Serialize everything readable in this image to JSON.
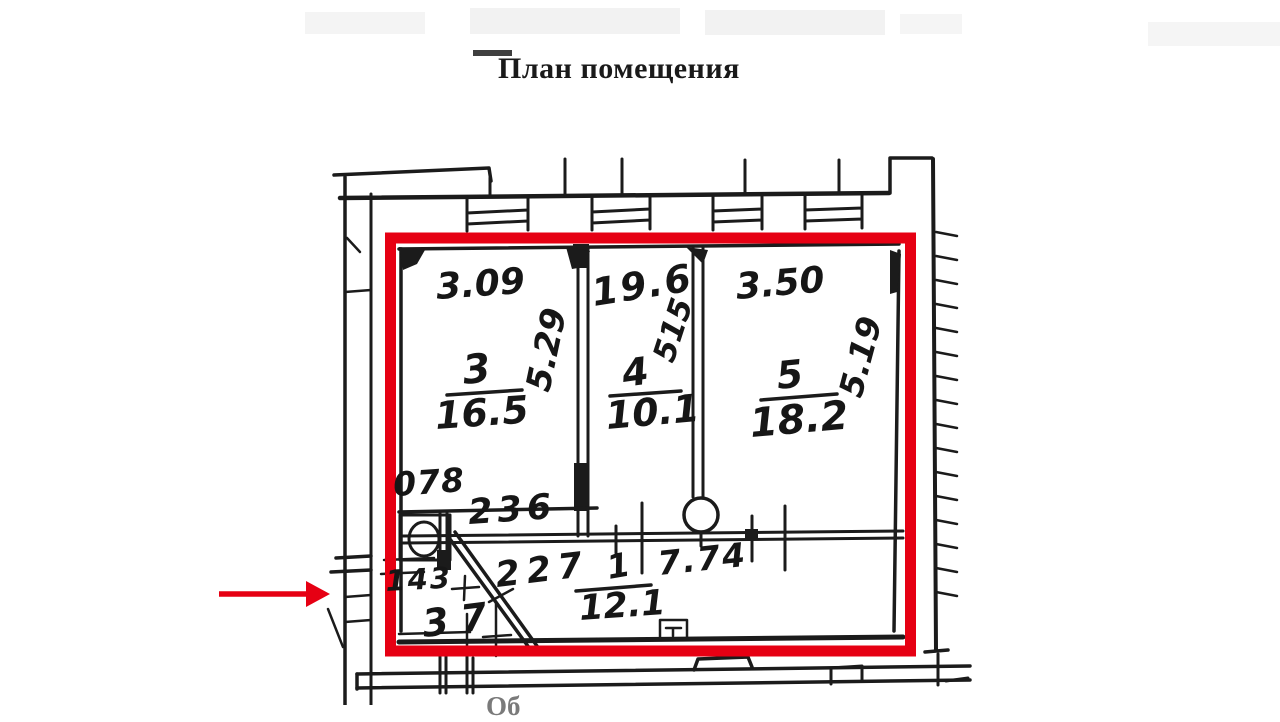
{
  "page": {
    "title": "План помещения",
    "caption_partial": "Об"
  },
  "plan": {
    "highlight_color": "#e60013",
    "rooms": [
      {
        "number": "3",
        "area": "16.5"
      },
      {
        "number": "4",
        "area": "10.1"
      },
      {
        "number": "5",
        "area": "18.2"
      },
      {
        "number": "1",
        "area": "12.1"
      }
    ],
    "dimensions": {
      "top": {
        "room3": "3.09",
        "room4": "19.6",
        "room5": "3.50"
      },
      "side": {
        "room3": "5.29",
        "room4": "515",
        "room5": "5.19"
      },
      "bottom": {
        "wc": "078",
        "a": "236",
        "b": "227",
        "c": "143",
        "d": "37",
        "corridor": "7.74"
      }
    }
  }
}
